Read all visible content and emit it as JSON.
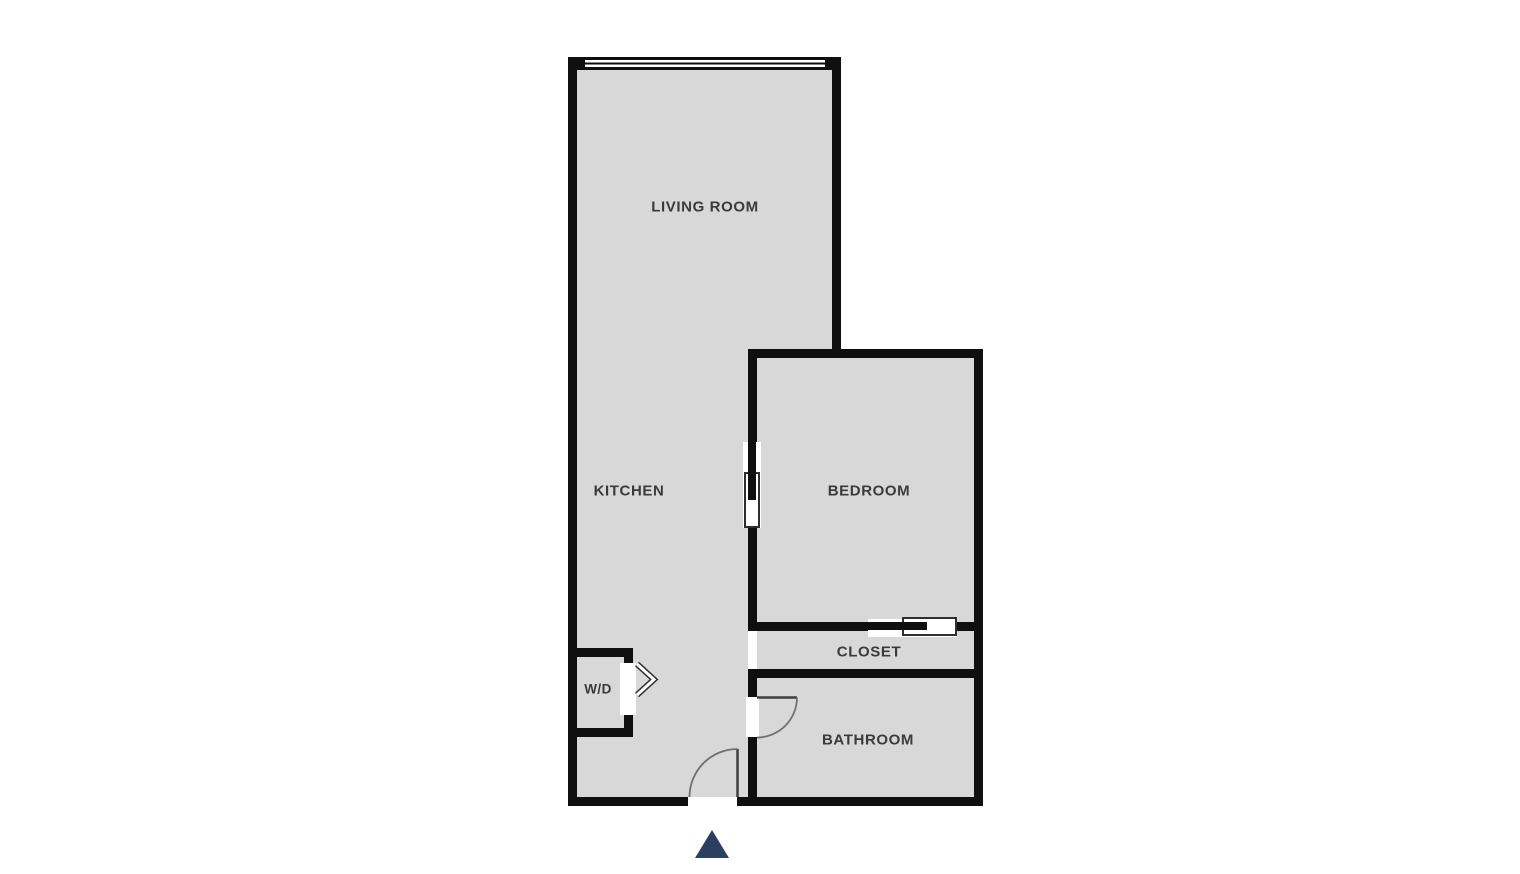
{
  "floorplan": {
    "rooms": [
      {
        "id": "living-room",
        "label": "LIVING ROOM"
      },
      {
        "id": "kitchen",
        "label": "KITCHEN"
      },
      {
        "id": "bedroom",
        "label": "BEDROOM"
      },
      {
        "id": "closet",
        "label": "CLOSET"
      },
      {
        "id": "bathroom",
        "label": "BATHROOM"
      },
      {
        "id": "washer-dryer",
        "label": "W/D"
      }
    ],
    "symbols": {
      "window": {
        "wall": "top",
        "room": "living-room",
        "style": "double-line"
      },
      "entrance_arrow": {
        "direction": "up",
        "location": "bottom-entry"
      },
      "doors": [
        {
          "type": "hinged",
          "location": "entry",
          "swing": "inward-left"
        },
        {
          "type": "hinged",
          "location": "bathroom",
          "swing": "inward-right"
        },
        {
          "type": "pocket",
          "location": "bedroom-left-wall"
        },
        {
          "type": "sliding",
          "location": "bedroom-closet-wall"
        },
        {
          "type": "bifold",
          "location": "washer-dryer"
        }
      ]
    },
    "colors": {
      "page_bg": "#ffffff",
      "wall": "#0f0f0f",
      "floor": "#d8d8d8",
      "label": "#3a3a3a",
      "arrow": "#2d3f61",
      "door_leaf": "#3f3f3f",
      "door_arc": "#707070",
      "panel_outline": "#2f2f2f"
    }
  }
}
